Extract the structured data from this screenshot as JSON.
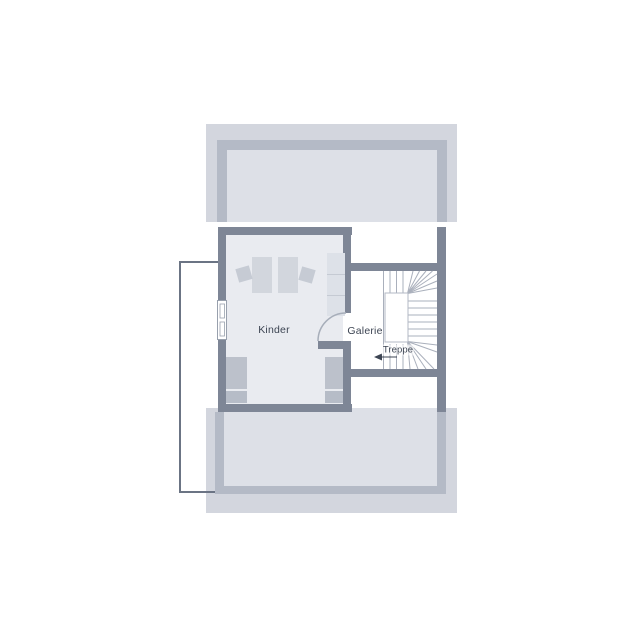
{
  "plan_type": "attic-floor-plan",
  "rooms": [
    {
      "id": "kinder",
      "label": "Kinder"
    },
    {
      "id": "galerie",
      "label": "Galerie"
    },
    {
      "id": "treppe",
      "label": "Treppe"
    }
  ],
  "stairs": {
    "shape": "u-winder",
    "direction_arrow": "left"
  },
  "palette": {
    "wall_dark": "#7e8696",
    "wall_light": "#b4bac6",
    "roof_band": "#d3d6de",
    "roof_interior": "#dde0e7",
    "room_floor": "#e9ebf0",
    "furniture_gray": "#c6cbd4",
    "tread_line": "#aab0bc",
    "label_text": "#3d4553",
    "footprint_outline": "#6b7484"
  }
}
